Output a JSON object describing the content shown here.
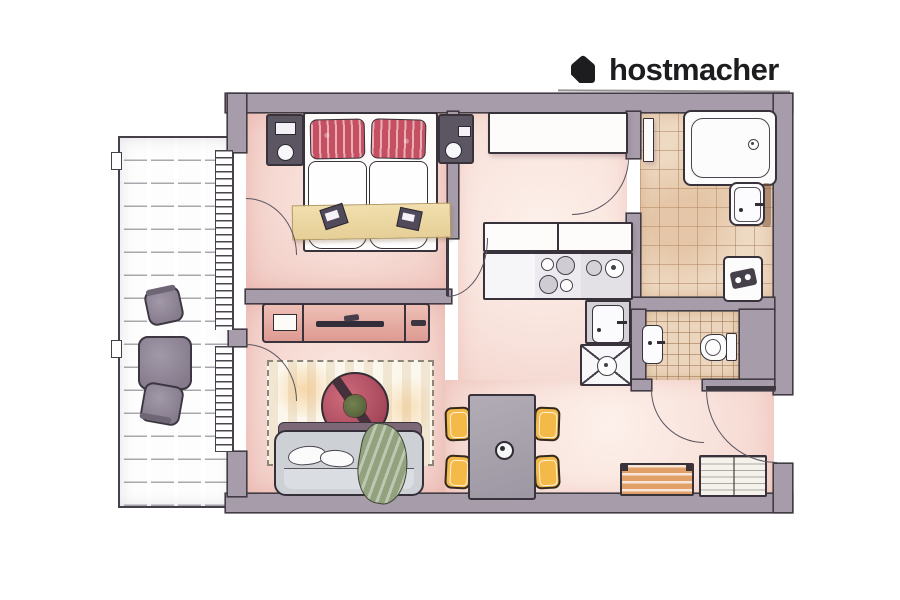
{
  "brand": {
    "logo_text": "hostmacher",
    "logo_icon": "house-logo-icon",
    "logo_color": "#1d1d1f"
  },
  "palette": {
    "wall": "#a79daa",
    "outline": "#413b44",
    "floor_pink": "#f5d8d1",
    "floor_pale": "#f8e2db",
    "tile_beige": "#eed9c2",
    "tile_wc": "#ebd5bc",
    "pillow_red": "#c65062",
    "runner_beige": "#eed9a7",
    "chair_yellow": "#f3ba4a",
    "bench_wood": "#e2a069",
    "sofa_gray": "#cdd1d5",
    "blanket_green": "#93a27e",
    "coffee_table_red": "#a34458",
    "balcony_furniture": "#8e8492"
  },
  "floorplan": {
    "balcony": {
      "furniture": [
        "balcony-chair",
        "balcony-table",
        "balcony-chair"
      ]
    },
    "bedroom": {
      "furniture": [
        "nightstand",
        "double-bed",
        "pillow",
        "pillow",
        "duvet",
        "duvet",
        "bed-runner",
        "book",
        "book",
        "nightstand"
      ]
    },
    "corridor": {
      "furniture": [
        "wardrobe",
        "wall-shelf"
      ]
    },
    "kitchen": {
      "furniture": [
        "counter-top",
        "stove-burners",
        "kitchen-sink",
        "corner-unit"
      ]
    },
    "bathroom": {
      "furniture": [
        "bathtub",
        "washbasin",
        "washing-machine"
      ]
    },
    "wc": {
      "furniture": [
        "washbasin",
        "toilet"
      ]
    },
    "living_room": {
      "furniture": [
        "tv-sideboard",
        "tv",
        "rug",
        "coffee-table",
        "plant",
        "sofa",
        "sofa-pillows",
        "throw-blanket"
      ]
    },
    "dining": {
      "furniture": [
        "dining-table",
        "vase",
        "chair",
        "chair",
        "chair",
        "chair"
      ]
    },
    "hallway": {
      "furniture": [
        "shoe-bench",
        "hall-shelf"
      ]
    },
    "doors": [
      "bedroom-balcony-door",
      "living-balcony-door",
      "bedroom-door",
      "bathroom-door",
      "wc-door",
      "entrance-door"
    ],
    "windows": [
      "balcony-window-upper",
      "balcony-window-lower"
    ]
  }
}
